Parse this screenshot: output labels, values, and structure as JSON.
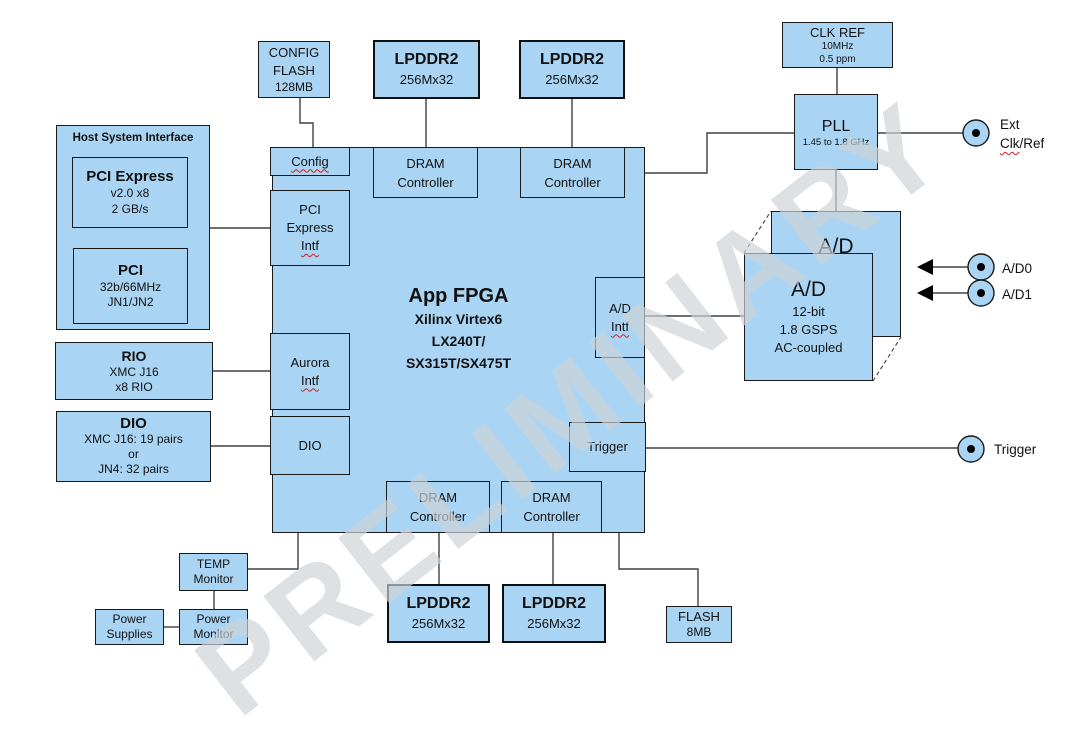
{
  "watermark": "PRELIMINARY",
  "colors": {
    "block_fill": "#a9d4f3",
    "border": "#1a1a1a",
    "wire": "#404040",
    "squiggle": "#cc2222",
    "watermark_gray": "#ced3d8"
  },
  "blocks": {
    "config_flash": [
      "CONFIG",
      "FLASH",
      "128MB"
    ],
    "lpddr2": [
      "LPDDR2",
      "256Mx32"
    ],
    "clk_ref": [
      "CLK REF",
      "10MHz",
      "0.5 ppm"
    ],
    "pll": [
      "PLL",
      "1.45 to 1.8 GHz"
    ],
    "host": {
      "title": "Host System Interface",
      "pcie": [
        "PCI Express",
        "v2.0 x8",
        "2 GB/s"
      ],
      "pci": [
        "PCI",
        "32b/66MHz",
        "JN1/JN2"
      ]
    },
    "rio": [
      "RIO",
      "XMC J16",
      "x8 RIO"
    ],
    "dio": [
      "DIO",
      "XMC J16: 19 pairs",
      "or",
      "JN4: 32 pairs"
    ],
    "fpga": [
      "App FPGA",
      "Xilinx Virtex6",
      "LX240T/",
      "SX315T/SX475T"
    ],
    "intf": {
      "config": "Config",
      "pcie": [
        "PCI",
        "Express",
        "Intf"
      ],
      "aurora": [
        "Aurora",
        "Intf"
      ],
      "dio": "DIO",
      "ad": [
        "A/D",
        "Intf"
      ],
      "trigger": "Trigger"
    },
    "dram": [
      "DRAM",
      "Controller"
    ],
    "adc": [
      "A/D",
      "12-bit",
      "1.8 GSPS",
      "AC-coupled"
    ],
    "temp_monitor": [
      "TEMP",
      "Monitor"
    ],
    "power_monitor": [
      "Power",
      "Monitor"
    ],
    "power_supplies": [
      "Power",
      "Supplies"
    ],
    "flash": [
      "FLASH",
      "8MB"
    ]
  },
  "io": {
    "ext": {
      "line1": "Ext",
      "clk": "Clk",
      "ref": "/Ref"
    },
    "ad0": "A/D0",
    "ad1": "A/D1",
    "trigger": "Trigger"
  }
}
